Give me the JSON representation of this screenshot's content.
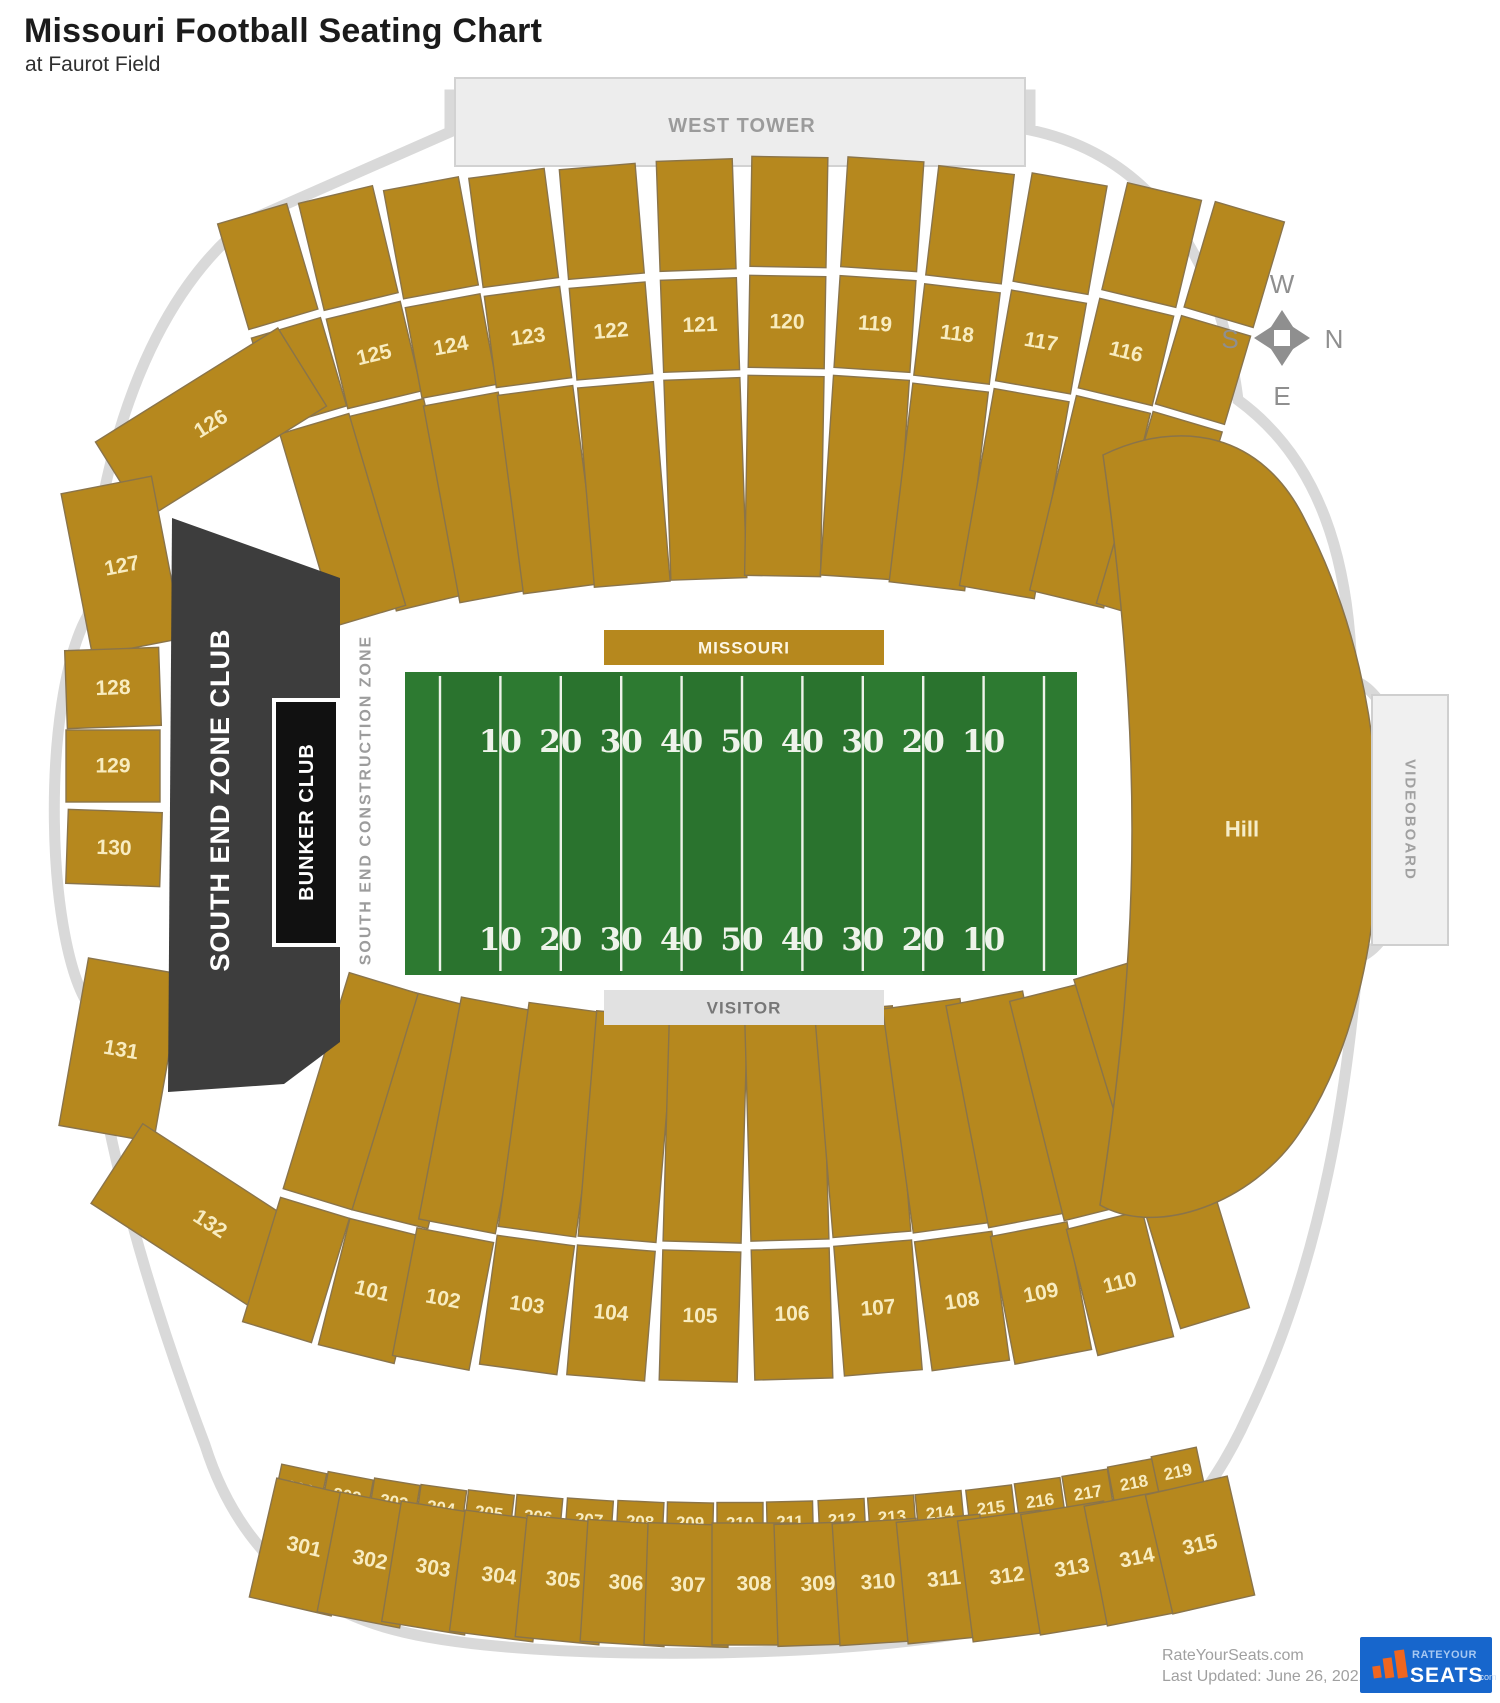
{
  "page": {
    "title": "Missouri Football Seating Chart",
    "subtitle": "at Faurot Field"
  },
  "west_tower": {
    "label": "WEST TOWER"
  },
  "labels": {
    "missouri": "MISSOURI",
    "visitor": "VISITOR",
    "hill": "Hill",
    "videoboard": "VIDEOBOARD",
    "south_end_zone_club": "SOUTH END ZONE CLUB",
    "bunker_club": "BUNKER CLUB",
    "construction_zone": "SOUTH END CONSTRUCTION ZONE"
  },
  "compass": {
    "n": "N",
    "s": "S",
    "e": "E",
    "w": "W"
  },
  "field": {
    "yard_numbers": [
      "10",
      "20",
      "30",
      "40",
      "50",
      "40",
      "30",
      "20",
      "10"
    ]
  },
  "colors": {
    "gold": "#b6881e",
    "gold_stroke": "#8a744a",
    "section_text": "#f8ecc0",
    "field_green": "#2d7a31",
    "club_dark": "#3d3d3d",
    "bunker_black": "#111111",
    "gray_box": "#ededed",
    "outline_gray": "#d9d9d9",
    "logo_blue": "#1766cc",
    "logo_orange": "#f0661f"
  },
  "sections": {
    "upper_deck": [
      {
        "label": "125",
        "cx": 374,
        "cy": 355,
        "a": -13.5
      },
      {
        "label": "124",
        "cx": 451,
        "cy": 346,
        "a": -10.5
      },
      {
        "label": "123",
        "cx": 528,
        "cy": 337,
        "a": -7.5
      },
      {
        "label": "122",
        "cx": 611,
        "cy": 331,
        "a": -4.8
      },
      {
        "label": "121",
        "cx": 700,
        "cy": 325,
        "a": -2
      },
      {
        "label": "120",
        "cx": 787,
        "cy": 322,
        "a": 1
      },
      {
        "label": "119",
        "cx": 875,
        "cy": 324,
        "a": 3.8
      },
      {
        "label": "118",
        "cx": 957,
        "cy": 334,
        "a": 6.8
      },
      {
        "label": "117",
        "cx": 1041,
        "cy": 342,
        "a": 10
      },
      {
        "label": "116",
        "cx": 1126,
        "cy": 352,
        "a": 13.5
      }
    ],
    "upper_deck_edges": [
      {
        "cx": 299,
        "cy": 372,
        "a": -16.5
      },
      {
        "cx": 1203,
        "cy": 370,
        "a": 16.5
      }
    ],
    "left_arc": [
      {
        "label": "126",
        "cx": 211,
        "cy": 424,
        "a": -32,
        "w": 215,
        "h": 92
      },
      {
        "label": "127",
        "cx": 122,
        "cy": 566,
        "a": -11,
        "w": 92,
        "h": 165
      },
      {
        "label": "128",
        "cx": 113,
        "cy": 688,
        "a": -2,
        "w": 94,
        "h": 78
      },
      {
        "label": "129",
        "cx": 113,
        "cy": 766,
        "a": 0,
        "w": 94,
        "h": 72
      },
      {
        "label": "130",
        "cx": 114,
        "cy": 848,
        "a": 2,
        "w": 94,
        "h": 74
      },
      {
        "label": "131",
        "cx": 121,
        "cy": 1050,
        "a": 10,
        "w": 96,
        "h": 170
      },
      {
        "label": "132",
        "cx": 210,
        "cy": 1224,
        "a": 33,
        "w": 222,
        "h": 95
      }
    ],
    "lower_bowl": [
      {
        "label": "101",
        "cx": 372,
        "cy": 1291,
        "a": 14
      },
      {
        "label": "102",
        "cx": 443,
        "cy": 1299,
        "a": 10.9
      },
      {
        "label": "103",
        "cx": 527,
        "cy": 1305,
        "a": 7.8
      },
      {
        "label": "104",
        "cx": 611,
        "cy": 1313,
        "a": 4.7
      },
      {
        "label": "105",
        "cx": 700,
        "cy": 1316,
        "a": 1.6
      },
      {
        "label": "106",
        "cx": 792,
        "cy": 1314,
        "a": -1.6
      },
      {
        "label": "107",
        "cx": 878,
        "cy": 1308,
        "a": -4.7
      },
      {
        "label": "108",
        "cx": 962,
        "cy": 1301,
        "a": -7.8
      },
      {
        "label": "109",
        "cx": 1041,
        "cy": 1293,
        "a": -10.9
      },
      {
        "label": "110",
        "cx": 1120,
        "cy": 1283,
        "a": -14
      }
    ],
    "lower_bowl_edges": [
      {
        "cx": 296,
        "cy": 1270,
        "a": 17
      },
      {
        "cx": 1196,
        "cy": 1256,
        "a": -17
      }
    ],
    "row_200": [
      {
        "label": "201",
        "cx": 300,
        "cy": 1489,
        "a": 12
      },
      {
        "label": "202",
        "cx": 347,
        "cy": 1496,
        "a": 10.7
      },
      {
        "label": "203",
        "cx": 394,
        "cy": 1502,
        "a": 9.3
      },
      {
        "label": "204",
        "cx": 441,
        "cy": 1508,
        "a": 8
      },
      {
        "label": "205",
        "cx": 489,
        "cy": 1513,
        "a": 6.7
      },
      {
        "label": "206",
        "cx": 538,
        "cy": 1517,
        "a": 5.3
      },
      {
        "label": "207",
        "cx": 589,
        "cy": 1520,
        "a": 4
      },
      {
        "label": "208",
        "cx": 640,
        "cy": 1522,
        "a": 2.7
      },
      {
        "label": "209",
        "cx": 690,
        "cy": 1523,
        "a": 1.3
      },
      {
        "label": "210",
        "cx": 740,
        "cy": 1523,
        "a": 0
      },
      {
        "label": "211",
        "cx": 790,
        "cy": 1522,
        "a": -1.3
      },
      {
        "label": "212",
        "cx": 842,
        "cy": 1520,
        "a": -2.7
      },
      {
        "label": "213",
        "cx": 892,
        "cy": 1517,
        "a": -4
      },
      {
        "label": "214",
        "cx": 940,
        "cy": 1513,
        "a": -5.3
      },
      {
        "label": "215",
        "cx": 991,
        "cy": 1508,
        "a": -6.7
      },
      {
        "label": "216",
        "cx": 1040,
        "cy": 1501,
        "a": -8
      },
      {
        "label": "217",
        "cx": 1088,
        "cy": 1493,
        "a": -9.3
      },
      {
        "label": "218",
        "cx": 1134,
        "cy": 1483,
        "a": -10.7
      },
      {
        "label": "219",
        "cx": 1178,
        "cy": 1472,
        "a": -12
      }
    ],
    "row_300": [
      {
        "label": "301",
        "cx": 304,
        "cy": 1547,
        "a": 13
      },
      {
        "label": "302",
        "cx": 370,
        "cy": 1560,
        "a": 11
      },
      {
        "label": "303",
        "cx": 433,
        "cy": 1568,
        "a": 9.3
      },
      {
        "label": "304",
        "cx": 499,
        "cy": 1576,
        "a": 7.4
      },
      {
        "label": "305",
        "cx": 563,
        "cy": 1580,
        "a": 5.6
      },
      {
        "label": "306",
        "cx": 626,
        "cy": 1583,
        "a": 3.7
      },
      {
        "label": "307",
        "cx": 688,
        "cy": 1585,
        "a": 1.9
      },
      {
        "label": "308",
        "cx": 754,
        "cy": 1584,
        "a": 0
      },
      {
        "label": "309",
        "cx": 818,
        "cy": 1584,
        "a": -1.9
      },
      {
        "label": "310",
        "cx": 878,
        "cy": 1582,
        "a": -3.7
      },
      {
        "label": "311",
        "cx": 944,
        "cy": 1579,
        "a": -5.6
      },
      {
        "label": "312",
        "cx": 1007,
        "cy": 1576,
        "a": -7.4
      },
      {
        "label": "313",
        "cx": 1072,
        "cy": 1568,
        "a": -9.3
      },
      {
        "label": "314",
        "cx": 1137,
        "cy": 1558,
        "a": -11
      },
      {
        "label": "315",
        "cx": 1200,
        "cy": 1545,
        "a": -13
      }
    ]
  },
  "footer": {
    "site": "RateYourSeats.com",
    "updated": "Last Updated: June 26, 2021",
    "logo_top": "RATEYOUR",
    "logo_main": "SEATS",
    "logo_suffix": ".com"
  }
}
